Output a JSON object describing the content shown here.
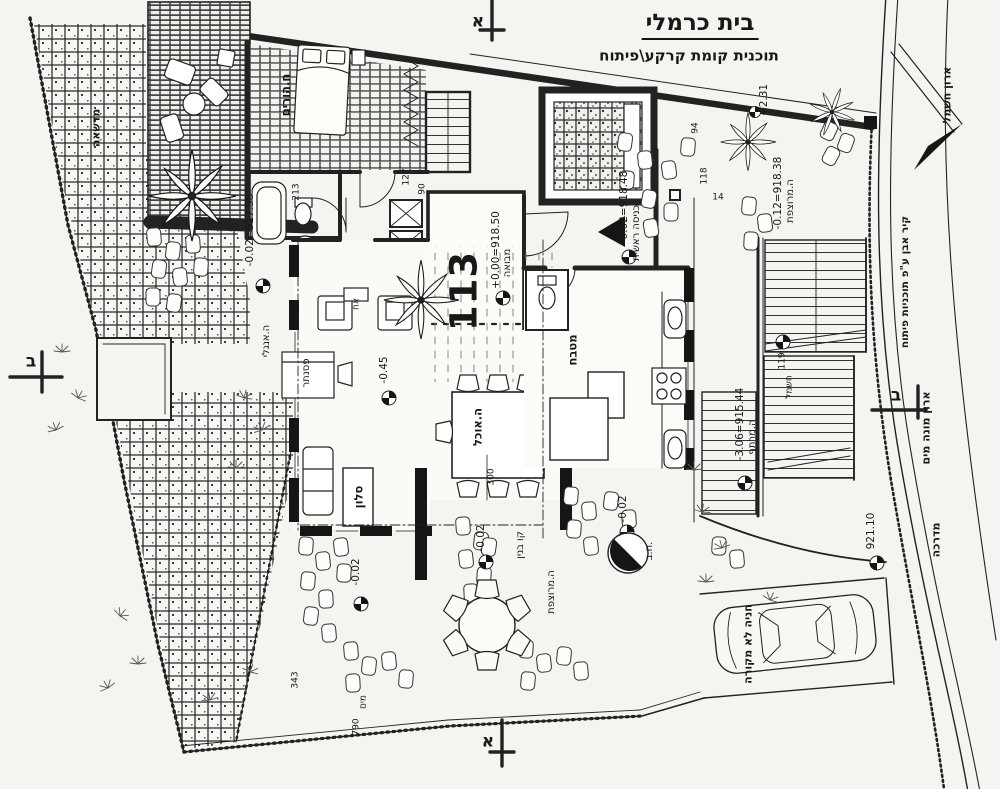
{
  "title_block": {
    "title": "בית כרמלי",
    "subtitle": "תוכנית קומת קרקע\\פיתוח"
  },
  "plot": {
    "number": "113"
  },
  "sections": {
    "top": "א",
    "bottom": "א",
    "left": "ב",
    "right": "ב"
  },
  "site": {
    "lawn": "מדשאה",
    "electric_cabinet": "ארון חשמל",
    "stone_wall_note": "קיר אבן ע\"פ תוכניות פיתוח",
    "water_meter_cabinet": "ארון מונה מים",
    "sidewalk": "מדרכה",
    "uncovered_parking": "חניה לא מקורה",
    "building_line": "קו בנין"
  },
  "rooms": {
    "parents_room": "ח.הורים",
    "kitchen": "מטבח",
    "living_room": "סלון",
    "dining": "ה.אוכל",
    "piano": "פסנתר",
    "english_court": "ה.אנגלי",
    "fireplace": "אח",
    "foyer": "מבואה",
    "main_entrance": "כניסה ראשית",
    "paved_court_right": "ה.מרוצפת",
    "paved_court_bottom": "ה.מרוצפת",
    "basement_court": "ה.מרתף",
    "inspection_chamber": "ח.ב."
  },
  "elevations": {
    "foyer_zero": "+0.00=918.50",
    "entrance": "-0.02=918.48",
    "court_right": "-0.12=918.38",
    "upper": "+2.31",
    "basement": "-3.06=915.44",
    "road": "921.10",
    "west_terrace": "-0.02=917.98",
    "living_step": "-0.45",
    "court_a": "-0.02",
    "court_b": "-0.02",
    "court_c": "-0.02"
  },
  "dimensions": {
    "d127": "127",
    "d90": "90",
    "d213": "213",
    "d118": "118",
    "d14": "14",
    "d94": "94",
    "d119": "119",
    "electric": "חשמל",
    "d343": "343",
    "d790": "790",
    "water": "מים",
    "d300": "300"
  }
}
